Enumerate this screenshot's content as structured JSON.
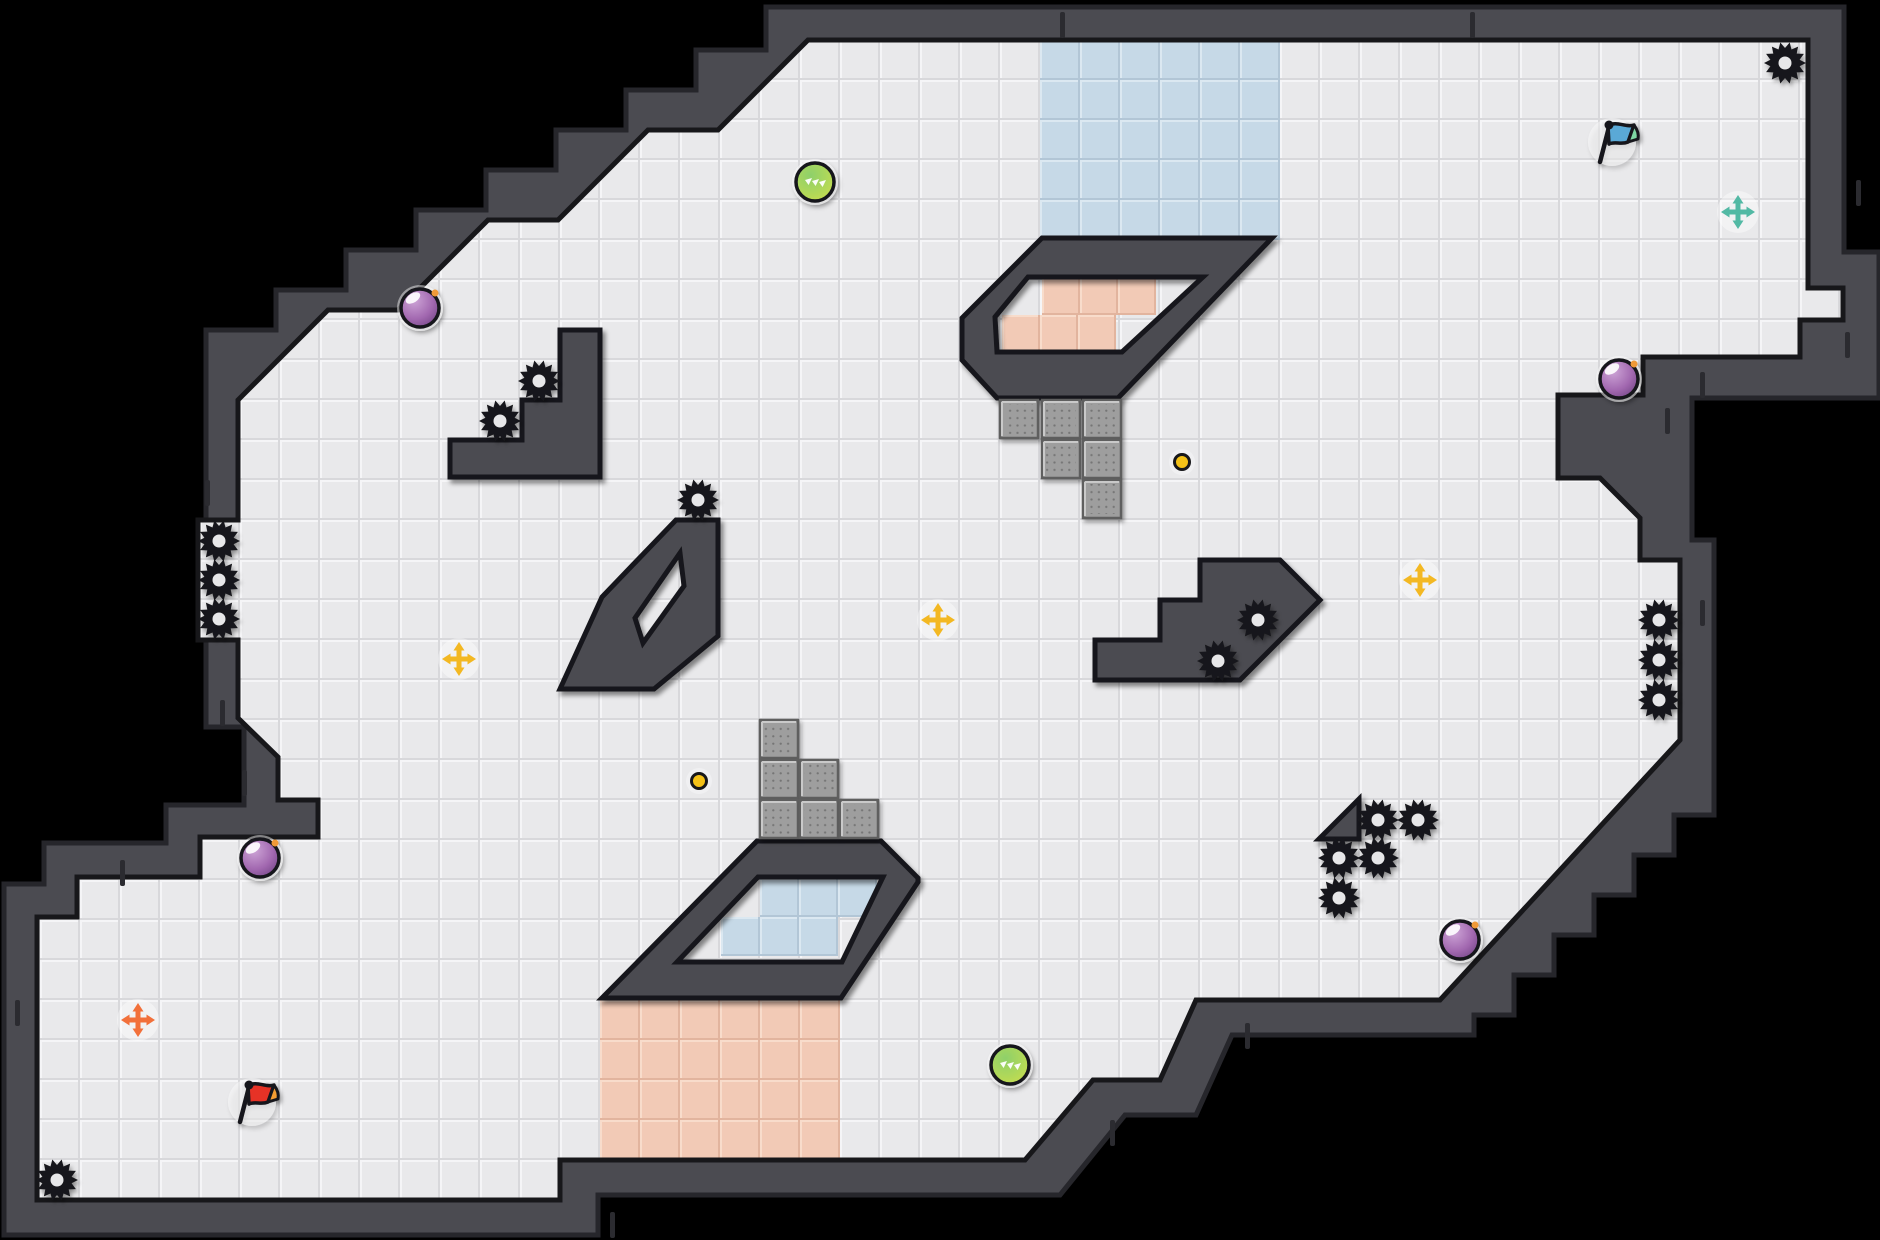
{
  "scene": {
    "width": 1880,
    "height": 1240,
    "background": "#000000"
  },
  "palette": {
    "void": "#000000",
    "wall": "#4b4b51",
    "wall_edge": "#26262b",
    "wall_seam": "#2b2b30",
    "boundary": "#17171a",
    "floor_base": "#e9e9eb",
    "floor_hi": "#f5f5f7",
    "floor_lo": "#d8d8db",
    "blue_tile": {
      "base": "#c6d9e7",
      "hi": "#dbe8f1",
      "lo": "#b2c6d6"
    },
    "pink_tile": {
      "base": "#f2cab6",
      "hi": "#f8dccb",
      "lo": "#e2b49e"
    },
    "block_base": "#9e9e9e",
    "block_dot": "#757575",
    "block_edge": "#5f5f5f",
    "block_hi": "#c9c9c9",
    "gear": "#17171a",
    "gear_hole": "#e7e7e9",
    "orb_purple": [
      "#cda4d6",
      "#a268b0",
      "#693d7d"
    ],
    "orb_green": [
      "#8ed06a",
      "#b4d957",
      "#d3de4a"
    ],
    "orb_outline": "#17171a",
    "orb_spark": "#f09a38",
    "dot_fill": "#f4c117",
    "cross_yellow": "#f3b822",
    "cross_orange": "#f2703a",
    "cross_teal": "#52b9a4",
    "flag_blue": {
      "cloth": "#5aa9d6",
      "tip": "#7ed6a2"
    },
    "flag_red": {
      "cloth": "#e63228",
      "tip": "#f59d33"
    },
    "halo": "#ffffff"
  },
  "map": {
    "floor": [
      [
        880,
        40
      ],
      [
        1808,
        40
      ],
      [
        1808,
        288
      ],
      [
        1843,
        288
      ],
      [
        1843,
        320
      ],
      [
        1800,
        320
      ],
      [
        1800,
        357
      ],
      [
        1643,
        357
      ],
      [
        1643,
        395
      ],
      [
        1558,
        395
      ],
      [
        1558,
        478
      ],
      [
        1600,
        478
      ],
      [
        1640,
        518
      ],
      [
        1640,
        560
      ],
      [
        1680,
        560
      ],
      [
        1680,
        740
      ],
      [
        1440,
        1000
      ],
      [
        1196,
        1000
      ],
      [
        1160,
        1080
      ],
      [
        1093,
        1080
      ],
      [
        1025,
        1160
      ],
      [
        560,
        1160
      ],
      [
        560,
        1200
      ],
      [
        37,
        1200
      ],
      [
        37,
        917
      ],
      [
        77,
        917
      ],
      [
        77,
        877
      ],
      [
        200,
        877
      ],
      [
        200,
        837
      ],
      [
        318,
        837
      ],
      [
        318,
        800
      ],
      [
        278,
        800
      ],
      [
        278,
        757
      ],
      [
        238,
        718
      ],
      [
        238,
        640
      ],
      [
        198,
        640
      ],
      [
        198,
        520
      ],
      [
        238,
        520
      ],
      [
        238,
        400
      ],
      [
        328,
        310
      ],
      [
        398,
        310
      ],
      [
        488,
        220
      ],
      [
        558,
        220
      ],
      [
        648,
        130
      ],
      [
        718,
        130
      ],
      [
        808,
        40
      ]
    ],
    "wall_outline": [
      [
        845,
        7
      ],
      [
        1844,
        7
      ],
      [
        1844,
        252
      ],
      [
        1879,
        252
      ],
      [
        1879,
        398
      ],
      [
        1692,
        398
      ],
      [
        1692,
        540
      ],
      [
        1714,
        540
      ],
      [
        1714,
        815
      ],
      [
        1674,
        815
      ],
      [
        1674,
        855
      ],
      [
        1634,
        855
      ],
      [
        1634,
        895
      ],
      [
        1594,
        895
      ],
      [
        1594,
        935
      ],
      [
        1554,
        935
      ],
      [
        1554,
        975
      ],
      [
        1514,
        975
      ],
      [
        1514,
        1015
      ],
      [
        1474,
        1015
      ],
      [
        1474,
        1035
      ],
      [
        1232,
        1035
      ],
      [
        1196,
        1115
      ],
      [
        1125,
        1115
      ],
      [
        1060,
        1195
      ],
      [
        598,
        1195
      ],
      [
        598,
        1235
      ],
      [
        4,
        1235
      ],
      [
        4,
        884
      ],
      [
        44,
        884
      ],
      [
        44,
        843
      ],
      [
        166,
        843
      ],
      [
        166,
        805
      ],
      [
        244,
        805
      ],
      [
        244,
        727
      ],
      [
        206,
        727
      ],
      [
        206,
        370
      ],
      [
        206,
        330
      ],
      [
        276,
        330
      ],
      [
        276,
        290
      ],
      [
        346,
        290
      ],
      [
        346,
        250
      ],
      [
        416,
        250
      ],
      [
        416,
        210
      ],
      [
        486,
        210
      ],
      [
        486,
        170
      ],
      [
        556,
        170
      ],
      [
        556,
        130
      ],
      [
        626,
        130
      ],
      [
        626,
        90
      ],
      [
        696,
        90
      ],
      [
        696,
        50
      ],
      [
        766,
        50
      ],
      [
        766,
        7
      ]
    ],
    "structures": [
      {
        "name": "stair-platform-left",
        "points": [
          [
            560,
            330
          ],
          [
            600,
            330
          ],
          [
            600,
            477
          ],
          [
            450,
            477
          ],
          [
            450,
            440
          ],
          [
            522,
            440
          ],
          [
            522,
            400
          ],
          [
            560,
            400
          ]
        ]
      },
      {
        "name": "diamond-ring",
        "points": [
          [
            676,
            520
          ],
          [
            718,
            520
          ],
          [
            718,
            636
          ],
          [
            654,
            689
          ],
          [
            560,
            689
          ],
          [
            602,
            597
          ]
        ],
        "hole": [
          [
            680,
            553
          ],
          [
            684,
            586
          ],
          [
            643,
            643
          ],
          [
            635,
            618
          ]
        ]
      },
      {
        "name": "ring-top",
        "points": [
          [
            1042,
            238
          ],
          [
            1272,
            238
          ],
          [
            1118,
            398
          ],
          [
            997,
            398
          ],
          [
            962,
            360
          ],
          [
            962,
            318
          ]
        ],
        "hole": [
          [
            1028,
            277
          ],
          [
            1203,
            277
          ],
          [
            1122,
            352
          ],
          [
            997,
            352
          ],
          [
            995,
            317
          ]
        ]
      },
      {
        "name": "ring-bottom",
        "points": [
          [
            757,
            841
          ],
          [
            881,
            841
          ],
          [
            918,
            878
          ],
          [
            918,
            882
          ],
          [
            841,
            998
          ],
          [
            602,
            998
          ]
        ],
        "hole": [
          [
            758,
            877
          ],
          [
            883,
            877
          ],
          [
            842,
            962
          ],
          [
            677,
            962
          ]
        ]
      },
      {
        "name": "stair-platform-right",
        "points": [
          [
            1200,
            560
          ],
          [
            1280,
            560
          ],
          [
            1320,
            600
          ],
          [
            1280,
            640
          ],
          [
            1240,
            680
          ],
          [
            1095,
            680
          ],
          [
            1095,
            640
          ],
          [
            1160,
            640
          ],
          [
            1160,
            600
          ],
          [
            1200,
            600
          ]
        ]
      },
      {
        "name": "wedge",
        "points": [
          [
            1359,
            799
          ],
          [
            1359,
            839
          ],
          [
            1319,
            839
          ]
        ]
      }
    ],
    "regions": [
      {
        "name": "water-zone-top",
        "color": "blue_tile",
        "origin": [
          1040,
          40
        ],
        "cols": 6,
        "rows": 5,
        "size": 40
      },
      {
        "name": "lava-zone-bottom",
        "color": "pink_tile",
        "origin": [
          600,
          1000
        ],
        "cols": 6,
        "rows": 4,
        "size": 40
      },
      {
        "name": "lava-zone-ring-top",
        "color": "pink_tile",
        "size": 38,
        "tiles": [
          [
            1042,
            277
          ],
          [
            1080,
            277
          ],
          [
            1118,
            277
          ],
          [
            1002,
            315
          ],
          [
            1040,
            315
          ],
          [
            1078,
            315
          ]
        ]
      },
      {
        "name": "water-zone-ring-bottom",
        "color": "blue_tile",
        "size": 39,
        "tiles": [
          [
            760,
            878
          ],
          [
            799,
            878
          ],
          [
            838,
            878
          ],
          [
            721,
            917
          ],
          [
            760,
            917
          ],
          [
            799,
            917
          ]
        ]
      }
    ],
    "blocks": {
      "size": 38,
      "tiles": [
        [
          1000,
          400
        ],
        [
          1042,
          400
        ],
        [
          1083,
          400
        ],
        [
          1042,
          440
        ],
        [
          1083,
          440
        ],
        [
          1083,
          480
        ],
        [
          760,
          720
        ],
        [
          760,
          760
        ],
        [
          800,
          760
        ],
        [
          760,
          800
        ],
        [
          800,
          800
        ],
        [
          840,
          800
        ]
      ]
    },
    "seams": [
      [
        1060,
        12
      ],
      [
        1470,
        12
      ],
      [
        1856,
        180
      ],
      [
        1845,
        332
      ],
      [
        1700,
        372
      ],
      [
        1665,
        408
      ],
      [
        205,
        480
      ],
      [
        220,
        700
      ],
      [
        242,
        770
      ],
      [
        120,
        860
      ],
      [
        15,
        1000
      ],
      [
        610,
        1212
      ],
      [
        1110,
        1120
      ],
      [
        1245,
        1023
      ],
      [
        1700,
        600
      ]
    ]
  },
  "objects": {
    "gears": [
      [
        1785,
        63
      ],
      [
        57,
        1180
      ],
      [
        219,
        541
      ],
      [
        219,
        580
      ],
      [
        219,
        619
      ],
      [
        1659,
        620
      ],
      [
        1659,
        660
      ],
      [
        1659,
        700
      ],
      [
        539,
        381
      ],
      [
        500,
        421
      ],
      [
        698,
        500
      ],
      [
        1258,
        620
      ],
      [
        1218,
        661
      ],
      [
        1378,
        820
      ],
      [
        1418,
        820
      ],
      [
        1339,
        858
      ],
      [
        1378,
        858
      ],
      [
        1339,
        898
      ]
    ],
    "orbs": [
      {
        "x": 420,
        "y": 308,
        "kind": "purple"
      },
      {
        "x": 1619,
        "y": 379,
        "kind": "purple"
      },
      {
        "x": 260,
        "y": 858,
        "kind": "purple"
      },
      {
        "x": 1460,
        "y": 940,
        "kind": "purple"
      },
      {
        "x": 815,
        "y": 182,
        "kind": "green"
      },
      {
        "x": 1010,
        "y": 1065,
        "kind": "green"
      }
    ],
    "coins": [
      [
        1182,
        462
      ],
      [
        699,
        781
      ]
    ],
    "crosses": [
      {
        "x": 459,
        "y": 659,
        "kind": "yellow"
      },
      {
        "x": 938,
        "y": 620,
        "kind": "yellow"
      },
      {
        "x": 1420,
        "y": 580,
        "kind": "yellow"
      },
      {
        "x": 1738,
        "y": 212,
        "kind": "teal"
      },
      {
        "x": 138,
        "y": 1020,
        "kind": "orange"
      }
    ],
    "flags": [
      {
        "x": 1612,
        "y": 140,
        "kind": "blue"
      },
      {
        "x": 252,
        "y": 1100,
        "kind": "red"
      }
    ]
  }
}
